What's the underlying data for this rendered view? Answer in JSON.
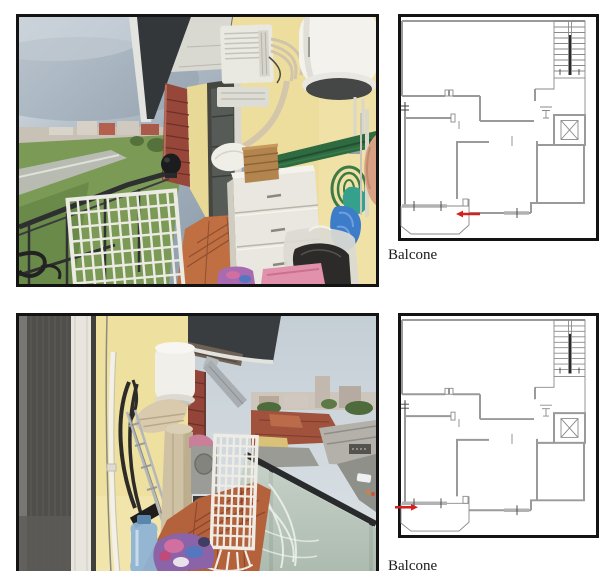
{
  "page": {
    "type": "photo-annex-page"
  },
  "colors": {
    "arrow_red": "#d61f1f",
    "frame_border": "#131313",
    "plan_wall": "#9a9a9a",
    "caption_color": "#1a1a1a",
    "page_bg": "#ffffff"
  },
  "figures": [
    {
      "caption": "Balcone",
      "photo": {
        "label": "balcony-photo-1",
        "alt": "Balcony with air conditioner, water heater and white shoe cabinet, overlooking green fields and an overcast sky"
      },
      "plan": {
        "label": "floor-plan-1",
        "alt": "Apartment floor plan with staircase and elevator; red arrow on the bottom-left balcony pointing left",
        "arrow": {
          "direction": "left",
          "x": 55,
          "y": 197,
          "length": 24
        }
      }
    },
    {
      "caption": "Balcone",
      "photo": {
        "label": "balcony-photo-2",
        "alt": "Balcony with folded drying rack and frosted glass railing overlooking town rooftops, a warehouse and a street"
      },
      "plan": {
        "label": "floor-plan-2",
        "alt": "Apartment floor plan with staircase and elevator; red arrow entering the bottom-left balcony from the left",
        "arrow": {
          "direction": "right",
          "x": 17,
          "y": 193,
          "length": 23
        }
      }
    }
  ]
}
